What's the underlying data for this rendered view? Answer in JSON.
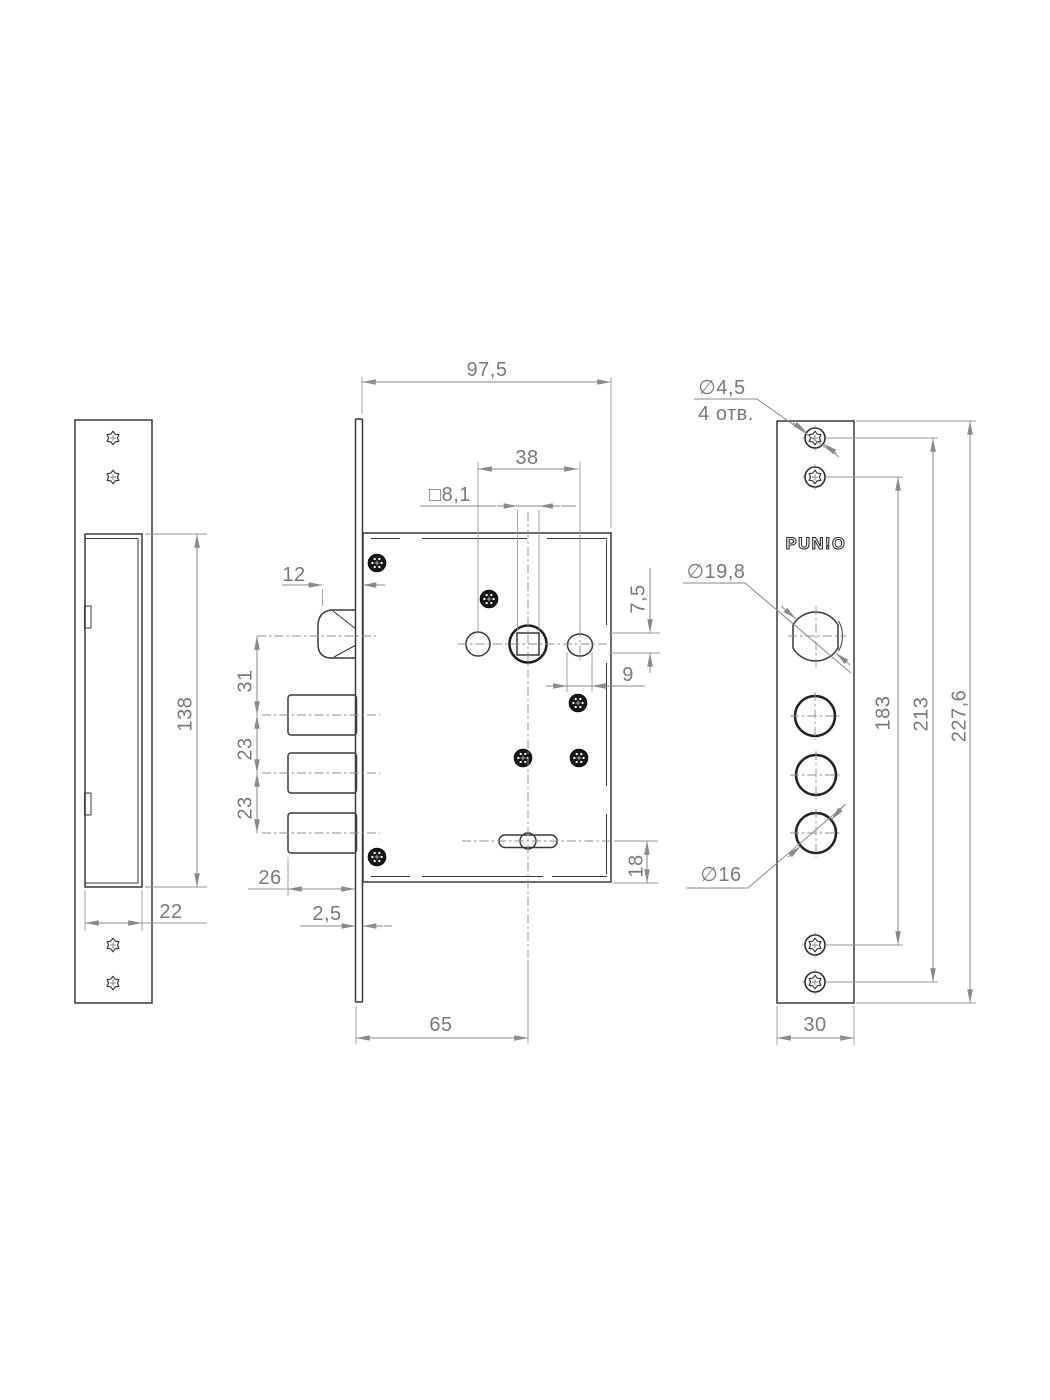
{
  "brand": {
    "name": "PUNTO",
    "logo_display": "PUN!O"
  },
  "dims": {
    "cutout_height": "138",
    "cutout_width": "22",
    "body_width": "97,5",
    "hole_spacing": "38",
    "square_size": "□8,1",
    "latch_projection": "12",
    "latch_to_bolt": "31",
    "bolt_pitch_a": "23",
    "bolt_pitch_b": "23",
    "bolt_throw": "26",
    "plate_thickness": "2,5",
    "backset": "65",
    "edge_offset": "7,5",
    "slot_offset": "9",
    "bottom_slot_offset": "18",
    "screw_hole_dia": "∅4,5",
    "screw_hole_count": "4 отв.",
    "cylinder_dia": "∅19,8",
    "bolt_dia": "∅16",
    "span_inner": "183",
    "span_outer": "213",
    "total_height": "227,6",
    "face_width": "30"
  }
}
